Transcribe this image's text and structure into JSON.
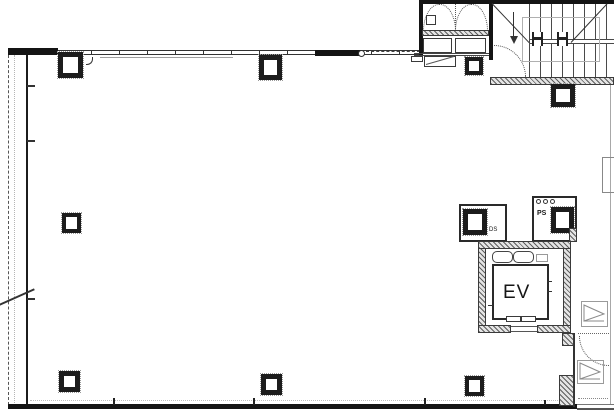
{
  "drawing": {
    "type": "architectural floor plan",
    "labels": {
      "elevator": "EV",
      "pipe_space": "PS",
      "duct_space": "DS"
    },
    "icons": {
      "stair_down_arrow": "down-arrow (flight direction)",
      "door_swing": "dotted quarter-arc",
      "shaft_symbol": "rectangle with chevron",
      "handrail_post": "H-shaped newel symbol"
    },
    "colors": {
      "line": "#141414",
      "hatch": "#5f5f5f",
      "light_line": "#9e9e9e",
      "background": "#ffffff"
    }
  }
}
